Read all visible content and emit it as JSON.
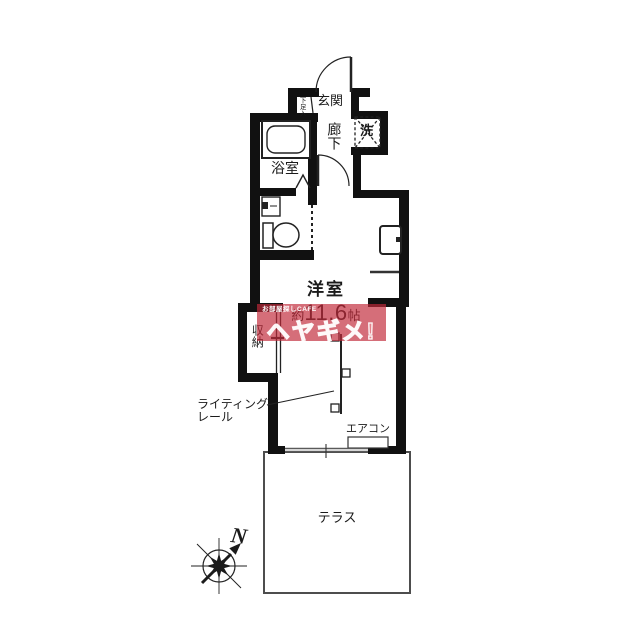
{
  "labels": {
    "entrance": "玄関",
    "shoe_cupboard": "下足入",
    "hallway": "廊下",
    "washer": "洗",
    "bathroom": "浴室",
    "western_room": "洋室",
    "size_about": "約",
    "size_value": "11.6",
    "size_unit": "帖",
    "closet": "収納",
    "lighting_rail_line1": "ライティング",
    "lighting_rail_line2": "レール",
    "air_conditioner": "エアコン",
    "terrace": "テラス",
    "compass_north": "N"
  },
  "watermark": {
    "small_text": "お部屋探しCAFE",
    "large_text": "ヘヤギメ!",
    "band_color": "#c12a3a"
  },
  "colors": {
    "wall": "#111111",
    "fixture_line": "#222222",
    "terrace_border": "#4d4d4d",
    "background": "#ffffff"
  }
}
